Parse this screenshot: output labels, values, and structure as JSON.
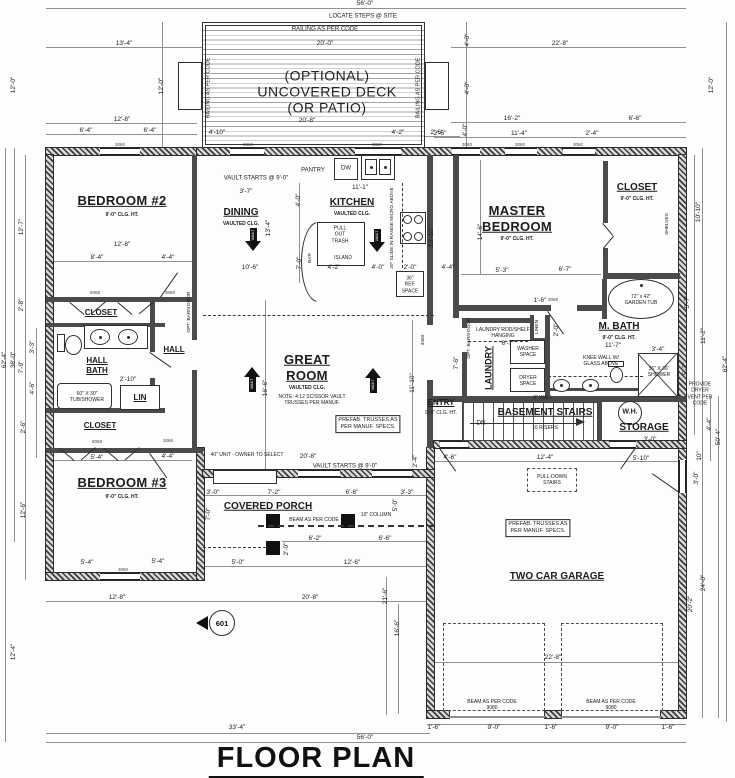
{
  "title": "FLOOR PLAN",
  "marker": "601",
  "colors": {
    "wall": "#3d3d3d",
    "line": "#909090",
    "text": "#1c1c1c",
    "paper": "#fdfdfc"
  },
  "labels": [
    {
      "t": "56'-0\"",
      "x": 365,
      "y": 4,
      "c": "dim"
    },
    {
      "t": "LOCATE STEPS @ SITE",
      "x": 363,
      "y": 17,
      "c": "note",
      "n": "steps-note"
    },
    {
      "t": "RAILING AS PER CODE",
      "x": 325,
      "y": 30,
      "c": "note",
      "n": "railing-note"
    },
    {
      "t": "20'-0\"",
      "x": 325,
      "y": 44,
      "c": "dim"
    },
    {
      "t": "(OPTIONAL)",
      "x": 327,
      "y": 76,
      "c": "big",
      "n": "deck-label"
    },
    {
      "t": "UNCOVERED DECK",
      "x": 327,
      "y": 92,
      "c": "big",
      "n": "deck-label"
    },
    {
      "t": "(OR PATIO)",
      "x": 327,
      "y": 108,
      "c": "big",
      "n": "deck-label"
    },
    {
      "t": "20'-8\"",
      "x": 307,
      "y": 121,
      "c": "dim"
    },
    {
      "t": "4'-10\"",
      "x": 217,
      "y": 133,
      "c": "dim"
    },
    {
      "t": "4'-2\"",
      "x": 398,
      "y": 133,
      "c": "dim"
    },
    {
      "t": "2'-6\"",
      "x": 437,
      "y": 133,
      "c": "dim"
    },
    {
      "t": "RAILING AS PER CODE",
      "x": 209,
      "y": 88,
      "c": "notev",
      "n": "railing-note"
    },
    {
      "t": "RAILING AS PER CODE",
      "x": 419,
      "y": 88,
      "c": "notev",
      "n": "railing-note"
    },
    {
      "t": "13'-4\"",
      "x": 124,
      "y": 44,
      "c": "dim"
    },
    {
      "t": "12'-0\"",
      "x": 162,
      "y": 86,
      "c": "dimv"
    },
    {
      "t": "12'-8\"",
      "x": 122,
      "y": 120,
      "c": "dim"
    },
    {
      "t": "6'-4\"",
      "x": 86,
      "y": 131,
      "c": "dim"
    },
    {
      "t": "6'-4\"",
      "x": 150,
      "y": 131,
      "c": "dim"
    },
    {
      "t": "22'-8\"",
      "x": 560,
      "y": 44,
      "c": "dim"
    },
    {
      "t": "4'-0\"",
      "x": 468,
      "y": 40,
      "c": "dimv"
    },
    {
      "t": "4'-0\"",
      "x": 468,
      "y": 88,
      "c": "dimv"
    },
    {
      "t": "4'-0\"",
      "x": 466,
      "y": 130,
      "c": "dimv"
    },
    {
      "t": "16'-2\"",
      "x": 512,
      "y": 119,
      "c": "dim"
    },
    {
      "t": "6'-6\"",
      "x": 635,
      "y": 119,
      "c": "dim"
    },
    {
      "t": "2'-6\"",
      "x": 440,
      "y": 134,
      "c": "dim"
    },
    {
      "t": "11'-4\"",
      "x": 519,
      "y": 134,
      "c": "dim"
    },
    {
      "t": "2'-4\"",
      "x": 592,
      "y": 134,
      "c": "dim"
    },
    {
      "t": "12'-0\"",
      "x": 712,
      "y": 85,
      "c": "dimv"
    },
    {
      "t": "62'-4\"",
      "x": 5,
      "y": 360,
      "c": "dimv"
    },
    {
      "t": "38'-0\"",
      "x": 14,
      "y": 360,
      "c": "dimv"
    },
    {
      "t": "12'-0\"",
      "x": 14,
      "y": 85,
      "c": "dimv"
    },
    {
      "t": "12'-7\"",
      "x": 22,
      "y": 227,
      "c": "dimv"
    },
    {
      "t": "2'-8\"",
      "x": 22,
      "y": 305,
      "c": "dimv"
    },
    {
      "t": "3'-3\"",
      "x": 33,
      "y": 347,
      "c": "dimv"
    },
    {
      "t": "7'-9\"",
      "x": 22,
      "y": 367,
      "c": "dimv"
    },
    {
      "t": "4'-6\"",
      "x": 33,
      "y": 388,
      "c": "dimv"
    },
    {
      "t": "2'-6\"",
      "x": 24,
      "y": 427,
      "c": "dimv"
    },
    {
      "t": "12'-6\"",
      "x": 24,
      "y": 510,
      "c": "dimv"
    },
    {
      "t": "12'-4\"",
      "x": 14,
      "y": 652,
      "c": "dimv"
    },
    {
      "t": "10'-10\"",
      "x": 699,
      "y": 212,
      "c": "dimv"
    },
    {
      "t": "5'-7\"",
      "x": 688,
      "y": 302,
      "c": "dimv"
    },
    {
      "t": "11'-2\"",
      "x": 704,
      "y": 336,
      "c": "dimv"
    },
    {
      "t": "5'-7\"",
      "x": 686,
      "y": 369,
      "c": "dimv"
    },
    {
      "t": "62'-4\"",
      "x": 726,
      "y": 364,
      "c": "dimv"
    },
    {
      "t": "PROVIDE DRYER\nVENT PER CODE",
      "x": 700,
      "y": 394,
      "c": "tiny",
      "n": "dryer-vent-note"
    },
    {
      "t": "4'-4\"",
      "x": 710,
      "y": 424,
      "c": "dimv"
    },
    {
      "t": "50'-4\"",
      "x": 719,
      "y": 437,
      "c": "dimv"
    },
    {
      "t": "10\"",
      "x": 700,
      "y": 456,
      "c": "dimv"
    },
    {
      "t": "3'-0\"",
      "x": 697,
      "y": 478,
      "c": "dimv"
    },
    {
      "t": "3'-4\"",
      "x": 658,
      "y": 350,
      "c": "dim"
    },
    {
      "t": "24'-0\"",
      "x": 704,
      "y": 583,
      "c": "dimv"
    },
    {
      "t": "20'-2\"",
      "x": 691,
      "y": 604,
      "c": "dimv"
    },
    {
      "t": "33'-4\"",
      "x": 237,
      "y": 728,
      "c": "dim"
    },
    {
      "t": "56'-0\"",
      "x": 365,
      "y": 738,
      "c": "dim"
    },
    {
      "t": "1'-6\"",
      "x": 434,
      "y": 728,
      "c": "dim"
    },
    {
      "t": "9'-0\"",
      "x": 494,
      "y": 728,
      "c": "dim"
    },
    {
      "t": "1'-6\"",
      "x": 551,
      "y": 728,
      "c": "dim"
    },
    {
      "t": "9'-0\"",
      "x": 612,
      "y": 728,
      "c": "dim"
    },
    {
      "t": "1'-6\"",
      "x": 668,
      "y": 728,
      "c": "dim"
    },
    {
      "t": "22'-8\"",
      "x": 553,
      "y": 658,
      "c": "dim"
    },
    {
      "t": "BEAM AS PER CODE\n9080",
      "x": 492,
      "y": 705,
      "c": "tiny",
      "n": "beam-note"
    },
    {
      "t": "BEAM AS PER CODE\n9080",
      "x": 611,
      "y": 705,
      "c": "tiny",
      "n": "beam-note"
    },
    {
      "t": "21'-6\"",
      "x": 386,
      "y": 596,
      "c": "dimv"
    },
    {
      "t": "16'-6\"",
      "x": 398,
      "y": 628,
      "c": "dimv"
    },
    {
      "t": "20'-8\"",
      "x": 310,
      "y": 598,
      "c": "dim"
    },
    {
      "t": "12'-8\"",
      "x": 117,
      "y": 598,
      "c": "dim"
    },
    {
      "t": "BEDROOM #2",
      "x": 122,
      "y": 201,
      "c": "room",
      "n": "room-label-bedroom2"
    },
    {
      "t": "9'-0\" CLG. HT.",
      "x": 122,
      "y": 215,
      "c": "cap"
    },
    {
      "t": "12'-8\"",
      "x": 122,
      "y": 245,
      "c": "dim"
    },
    {
      "t": "8'-4\"",
      "x": 97,
      "y": 258,
      "c": "dim"
    },
    {
      "t": "4'-4\"",
      "x": 168,
      "y": 258,
      "c": "dim"
    },
    {
      "t": "CLOSET",
      "x": 101,
      "y": 313,
      "c": "rxs",
      "n": "room-label-closet"
    },
    {
      "t": "HALL\nBATH",
      "x": 97,
      "y": 366,
      "c": "rxs",
      "n": "room-label-hall-bath"
    },
    {
      "t": "HALL",
      "x": 174,
      "y": 350,
      "c": "rxs",
      "n": "room-label-hall"
    },
    {
      "t": "2'-10\"",
      "x": 128,
      "y": 380,
      "c": "dim"
    },
    {
      "t": "60\" X 30\"\nTUB/SHOWER",
      "x": 87,
      "y": 397,
      "c": "tiny",
      "n": "tub-note"
    },
    {
      "t": "LIN",
      "x": 140,
      "y": 398,
      "c": "rxs",
      "n": "room-label-linen"
    },
    {
      "t": "CLOSET",
      "x": 100,
      "y": 426,
      "c": "rxs",
      "n": "room-label-closet"
    },
    {
      "t": "5'-4\"",
      "x": 97,
      "y": 458,
      "c": "dim"
    },
    {
      "t": "4'-4\"",
      "x": 168,
      "y": 457,
      "c": "dim"
    },
    {
      "t": "BEDROOM #3",
      "x": 122,
      "y": 483,
      "c": "room",
      "n": "room-label-bedroom3"
    },
    {
      "t": "9'-0\" CLG. HT.",
      "x": 122,
      "y": 497,
      "c": "cap"
    },
    {
      "t": "5'-4\"",
      "x": 87,
      "y": 563,
      "c": "dim"
    },
    {
      "t": "5'-4\"",
      "x": 158,
      "y": 562,
      "c": "dim"
    },
    {
      "t": "OPT. BARN DOOR",
      "x": 190,
      "y": 312,
      "c": "tinyv",
      "n": "barn-door-note"
    },
    {
      "t": "VAULT STARTS @ 9'-0\"",
      "x": 256,
      "y": 179,
      "c": "note",
      "n": "vault-note"
    },
    {
      "t": "3'-7\"",
      "x": 246,
      "y": 192,
      "c": "dim"
    },
    {
      "t": "DINING",
      "x": 241,
      "y": 213,
      "c": "rsm",
      "n": "room-label-dining"
    },
    {
      "t": "VAULTED CLG.",
      "x": 241,
      "y": 224,
      "c": "cap"
    },
    {
      "t": "13'-4\"",
      "x": 269,
      "y": 228,
      "c": "dimv"
    },
    {
      "t": "10'-6\"",
      "x": 250,
      "y": 268,
      "c": "dim"
    },
    {
      "t": "PANTRY",
      "x": 313,
      "y": 171,
      "c": "note",
      "n": "pantry-label"
    },
    {
      "t": "DW",
      "x": 346,
      "y": 169,
      "c": "note",
      "n": "dishwasher-label"
    },
    {
      "t": "11'-1\"",
      "x": 360,
      "y": 188,
      "c": "dim"
    },
    {
      "t": "KITCHEN",
      "x": 352,
      "y": 203,
      "c": "rsm",
      "n": "room-label-kitchen"
    },
    {
      "t": "VAULTED CLG.",
      "x": 352,
      "y": 214,
      "c": "cap"
    },
    {
      "t": "PULL\nOUT\nTRASH",
      "x": 340,
      "y": 235,
      "c": "tiny",
      "n": "trash-note"
    },
    {
      "t": "ISLAND",
      "x": 343,
      "y": 258,
      "c": "tiny",
      "n": "island-label"
    },
    {
      "t": "BAR",
      "x": 311,
      "y": 258,
      "c": "tinyv",
      "n": "bar-label"
    },
    {
      "t": "4'-2\"",
      "x": 334,
      "y": 268,
      "c": "dim"
    },
    {
      "t": "4'-0\"",
      "x": 378,
      "y": 268,
      "c": "dim"
    },
    {
      "t": "2'-0\"",
      "x": 410,
      "y": 268,
      "c": "dim"
    },
    {
      "t": "4'-4\"",
      "x": 448,
      "y": 268,
      "c": "dim"
    },
    {
      "t": "7'-0\"",
      "x": 300,
      "y": 263,
      "c": "dimv"
    },
    {
      "t": "4'-0\"",
      "x": 299,
      "y": 200,
      "c": "dimv"
    },
    {
      "t": "30\" SLIDE IN RANGE\nMICRO ABOVE",
      "x": 393,
      "y": 228,
      "c": "tinyv",
      "n": "range-note"
    },
    {
      "t": "36\"\nREF.\nSPACE",
      "x": 410,
      "y": 285,
      "c": "tiny",
      "n": "ref-note"
    },
    {
      "t": "13'-10\"",
      "x": 432,
      "y": 237,
      "c": "dimv"
    },
    {
      "t": "3460",
      "x": 424,
      "y": 340,
      "c": "tinyv",
      "n": "window-tag"
    },
    {
      "t": "MASTER\nBEDROOM",
      "x": 517,
      "y": 219,
      "c": "room",
      "n": "room-label-master-bedroom"
    },
    {
      "t": "9'-0\" CLG. HT.",
      "x": 517,
      "y": 239,
      "c": "cap"
    },
    {
      "t": "14'-6\"",
      "x": 481,
      "y": 232,
      "c": "dimv"
    },
    {
      "t": "5'-3\"",
      "x": 502,
      "y": 271,
      "c": "dim"
    },
    {
      "t": "6'-7\"",
      "x": 565,
      "y": 270,
      "c": "dim"
    },
    {
      "t": "1'-6\"",
      "x": 540,
      "y": 301,
      "c": "dim"
    },
    {
      "t": "CLOSET",
      "x": 637,
      "y": 188,
      "c": "rsm",
      "n": "room-label-master-closet"
    },
    {
      "t": "9'-0\" CLG. HT.",
      "x": 637,
      "y": 199,
      "c": "cap"
    },
    {
      "t": "SHELVES",
      "x": 668,
      "y": 224,
      "c": "tinyv",
      "n": "shelves-label"
    },
    {
      "t": "72\" x 42\"\nGARDEN TUB",
      "x": 641,
      "y": 300,
      "c": "tiny",
      "n": "garden-tub-label"
    },
    {
      "t": "M. BATH",
      "x": 619,
      "y": 327,
      "c": "rsm",
      "n": "room-label-master-bath"
    },
    {
      "t": "9'-0\" CLG. HT.",
      "x": 619,
      "y": 338,
      "c": "cap"
    },
    {
      "t": "11'-7\"",
      "x": 613,
      "y": 346,
      "c": "dim"
    },
    {
      "t": "KNEE WALL W/\nGLASS ABOVE",
      "x": 601,
      "y": 361,
      "c": "tiny",
      "n": "knee-wall-note"
    },
    {
      "t": "36\" X 36\"\nSHOWER",
      "x": 659,
      "y": 372,
      "c": "tiny",
      "n": "shower-label"
    },
    {
      "t": "6\" WALL",
      "x": 543,
      "y": 398,
      "c": "tiny",
      "n": "wall-note"
    },
    {
      "t": "2'-0\"",
      "x": 557,
      "y": 330,
      "c": "dimv"
    },
    {
      "t": "6'-7\"",
      "x": 508,
      "y": 344,
      "c": "dim"
    },
    {
      "t": "LAUNDRY",
      "x": 489,
      "y": 368,
      "c": "rsmv",
      "n": "room-label-laundry"
    },
    {
      "t": "LAUNDRY ROD/SHELF\nHANGING",
      "x": 503,
      "y": 333,
      "c": "tiny",
      "n": "laundry-rod-note"
    },
    {
      "t": "WASHER\nSPACE",
      "x": 528,
      "y": 352,
      "c": "tiny",
      "n": "washer-label"
    },
    {
      "t": "DRYER\nSPACE",
      "x": 528,
      "y": 381,
      "c": "tiny",
      "n": "dryer-label"
    },
    {
      "t": "LINEN",
      "x": 538,
      "y": 327,
      "c": "tinyv",
      "n": "room-label-linen"
    },
    {
      "t": "OPT. BARN DOOR",
      "x": 470,
      "y": 338,
      "c": "tinyv",
      "n": "barn-door-note"
    },
    {
      "t": "7'-6\"",
      "x": 457,
      "y": 363,
      "c": "dimv"
    },
    {
      "t": "ENTRY",
      "x": 441,
      "y": 403,
      "c": "rxs",
      "n": "room-label-entry"
    },
    {
      "t": "9'-0\" CLG. HT.",
      "x": 441,
      "y": 413,
      "c": "tiny"
    },
    {
      "t": "BASEMENT STAIRS",
      "x": 545,
      "y": 413,
      "c": "rsm",
      "n": "room-label-basement-stairs"
    },
    {
      "t": "DN",
      "x": 481,
      "y": 424,
      "c": "note",
      "n": "down-label"
    },
    {
      "t": "16 RISERS",
      "x": 545,
      "y": 428,
      "c": "tiny",
      "n": "risers-note"
    },
    {
      "t": "W.H.",
      "x": 630,
      "y": 413,
      "c": "wh",
      "n": "water-heater-label"
    },
    {
      "t": "STORAGE",
      "x": 644,
      "y": 428,
      "c": "rsm",
      "n": "room-label-storage"
    },
    {
      "t": "3'-0\"",
      "x": 650,
      "y": 440,
      "c": "dim"
    },
    {
      "t": "4'-6\"",
      "x": 450,
      "y": 458,
      "c": "dim"
    },
    {
      "t": "12'-4\"",
      "x": 545,
      "y": 458,
      "c": "dim"
    },
    {
      "t": "5'-10\"",
      "x": 641,
      "y": 459,
      "c": "dim"
    },
    {
      "t": "GREAT\nROOM",
      "x": 307,
      "y": 368,
      "c": "room",
      "n": "room-label-great-room"
    },
    {
      "t": "VAULTED CLG.",
      "x": 307,
      "y": 388,
      "c": "cap"
    },
    {
      "t": "NOTE: 4:12 SCISSOR VAULT\nTRUSSES PER MANUF.",
      "x": 312,
      "y": 400,
      "c": "tiny",
      "n": "truss-note"
    },
    {
      "t": "PREFAB. TRUSSES AS\nPER MANUF. SPECS.",
      "x": 368,
      "y": 424,
      "c": "noteb",
      "n": "prefab-truss-note"
    },
    {
      "t": "16'-6\"",
      "x": 266,
      "y": 388,
      "c": "dimv"
    },
    {
      "t": "11'-10\"",
      "x": 413,
      "y": 383,
      "c": "dimv"
    },
    {
      "t": "2'-4\"",
      "x": 416,
      "y": 461,
      "c": "dimv"
    },
    {
      "t": "20'-8\"",
      "x": 308,
      "y": 457,
      "c": "dim"
    },
    {
      "t": "VAULT STARTS @ 9'-0\"",
      "x": 345,
      "y": 467,
      "c": "note",
      "n": "vault-note"
    },
    {
      "t": "40\" UNIT - OWNER TO SELECT",
      "x": 247,
      "y": 455,
      "c": "tiny",
      "n": "fireplace-note"
    },
    {
      "t": "COVERED PORCH",
      "x": 268,
      "y": 507,
      "c": "rsm",
      "n": "room-label-covered-porch"
    },
    {
      "t": "3'-0\"",
      "x": 213,
      "y": 493,
      "c": "dim"
    },
    {
      "t": "7'-2\"",
      "x": 274,
      "y": 493,
      "c": "dim"
    },
    {
      "t": "6'-6\"",
      "x": 352,
      "y": 493,
      "c": "dim"
    },
    {
      "t": "3'-3\"",
      "x": 407,
      "y": 493,
      "c": "dim"
    },
    {
      "t": "5'-0\"",
      "x": 396,
      "y": 505,
      "c": "dimv"
    },
    {
      "t": "7'-0\"",
      "x": 209,
      "y": 514,
      "c": "dimv"
    },
    {
      "t": "BEAM AS PER CODE",
      "x": 314,
      "y": 520,
      "c": "tiny",
      "n": "beam-note"
    },
    {
      "t": "10\" COLUMN",
      "x": 376,
      "y": 515,
      "c": "tiny",
      "n": "column-note"
    },
    {
      "t": "6'-2\"",
      "x": 315,
      "y": 539,
      "c": "dim"
    },
    {
      "t": "6'-6\"",
      "x": 385,
      "y": 539,
      "c": "dim"
    },
    {
      "t": "2'-0\"",
      "x": 287,
      "y": 549,
      "c": "dimv"
    },
    {
      "t": "5'-0\"",
      "x": 238,
      "y": 563,
      "c": "dim"
    },
    {
      "t": "12'-6\"",
      "x": 352,
      "y": 563,
      "c": "dim"
    },
    {
      "t": "PULL-DOWN\nSTAIRS",
      "x": 552,
      "y": 480,
      "c": "tiny",
      "n": "pull-down-stairs-label"
    },
    {
      "t": "PREFAB. TRUSSES AS\nPER MANUF. SPECS.",
      "x": 538,
      "y": 528,
      "c": "noteb",
      "n": "prefab-truss-note"
    },
    {
      "t": "TWO CAR GARAGE",
      "x": 557,
      "y": 577,
      "c": "rsm",
      "n": "room-label-garage"
    },
    {
      "t": "VAULT",
      "x": 253,
      "y": 235,
      "c": "vav",
      "n": "vault-arrow-label"
    },
    {
      "t": "VAULT",
      "x": 377,
      "y": 236,
      "c": "vav",
      "n": "vault-arrow-label"
    },
    {
      "t": "VAULT",
      "x": 252,
      "y": 384,
      "c": "vav",
      "n": "vault-arrow-label"
    },
    {
      "t": "VAULT",
      "x": 373,
      "y": 385,
      "c": "vav",
      "n": "vault-arrow-label"
    },
    {
      "t": "3060",
      "x": 120,
      "y": 145,
      "c": "tag",
      "n": "window-tag"
    },
    {
      "t": "3068",
      "x": 248,
      "y": 145,
      "c": "tag",
      "n": "door-tag"
    },
    {
      "t": "8030",
      "x": 377,
      "y": 145,
      "c": "tag",
      "n": "window-tag"
    },
    {
      "t": "3060",
      "x": 467,
      "y": 145,
      "c": "tag",
      "n": "window-tag"
    },
    {
      "t": "3060",
      "x": 520,
      "y": 145,
      "c": "tag",
      "n": "window-tag"
    },
    {
      "t": "3060",
      "x": 578,
      "y": 145,
      "c": "tag",
      "n": "window-tag"
    },
    {
      "t": "3060",
      "x": 123,
      "y": 570,
      "c": "tag",
      "n": "window-tag"
    },
    {
      "t": "5068",
      "x": 95,
      "y": 293,
      "c": "tag",
      "n": "door-tag"
    },
    {
      "t": "3068",
      "x": 170,
      "y": 293,
      "c": "tag",
      "n": "door-tag"
    },
    {
      "t": "5068",
      "x": 97,
      "y": 442,
      "c": "tag",
      "n": "door-tag"
    },
    {
      "t": "3068",
      "x": 168,
      "y": 441,
      "c": "tag",
      "n": "door-tag"
    },
    {
      "t": "3068",
      "x": 553,
      "y": 300,
      "c": "tag",
      "n": "door-tag"
    }
  ]
}
